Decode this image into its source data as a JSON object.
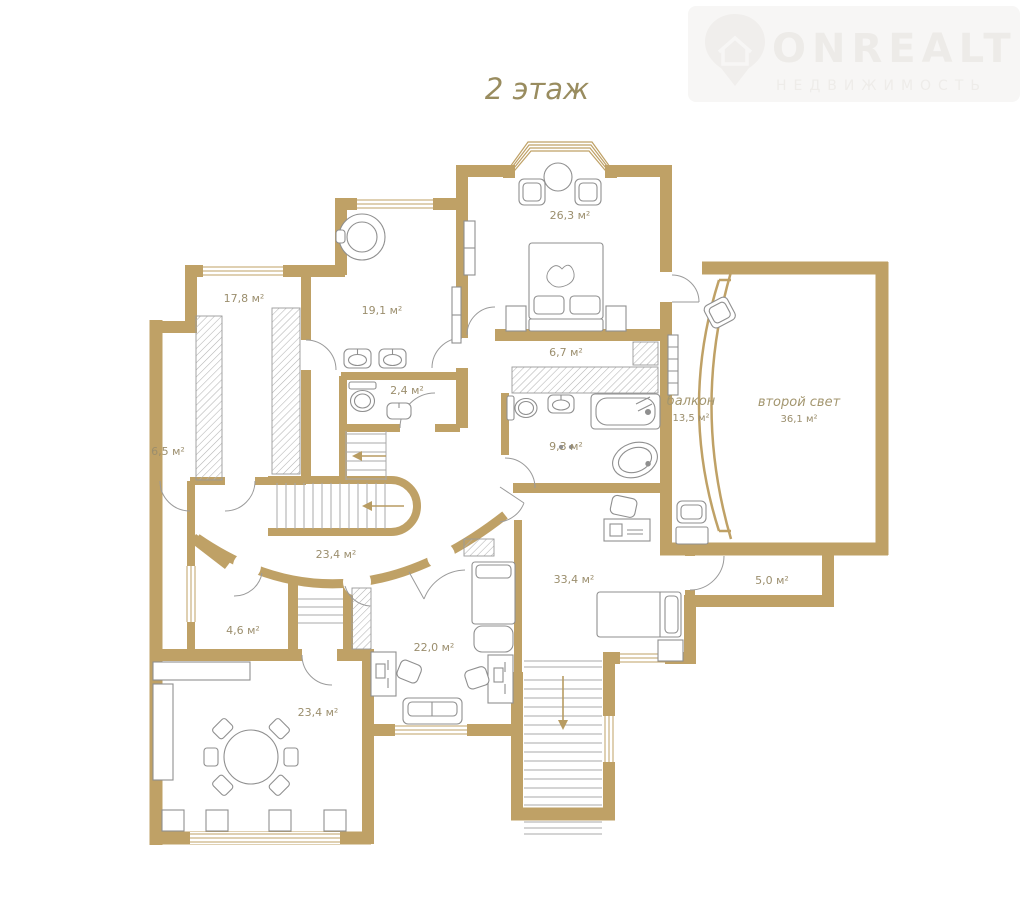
{
  "title": "2 этаж",
  "logo": {
    "brand": "ONREALT",
    "subtitle": "НЕДВИЖИМОСТЬ",
    "icon": "house-pin-icon"
  },
  "plan": {
    "wall_color": "#bfa166",
    "label_color": "#9b8e6d",
    "rooms": [
      {
        "id": "room-17-8",
        "area": "17,8 м²"
      },
      {
        "id": "room-19-1",
        "area": "19,1 м²"
      },
      {
        "id": "bedroom-26-3",
        "area": "26,3 м²"
      },
      {
        "id": "corridor-6-7",
        "area": "6,7 м²"
      },
      {
        "id": "wc-2-4",
        "area": "2,4 м²"
      },
      {
        "id": "room-6-5",
        "area": "6,5 м²"
      },
      {
        "id": "bathroom-9-3",
        "area": "9,3 м²"
      },
      {
        "id": "balcony",
        "name": "балкон",
        "area": "13,5 м²"
      },
      {
        "id": "second-light",
        "name": "второй свет",
        "area": "36,1 м²"
      },
      {
        "id": "hall-23-4",
        "area": "23,4 м²"
      },
      {
        "id": "room-4-6",
        "area": "4,6 м²"
      },
      {
        "id": "room-22-0",
        "area": "22,0 м²"
      },
      {
        "id": "room-33-4",
        "area": "33,4 м²"
      },
      {
        "id": "room-5-0",
        "area": "5,0 м²"
      },
      {
        "id": "dining-23-4",
        "area": "23,4 м²"
      }
    ]
  }
}
